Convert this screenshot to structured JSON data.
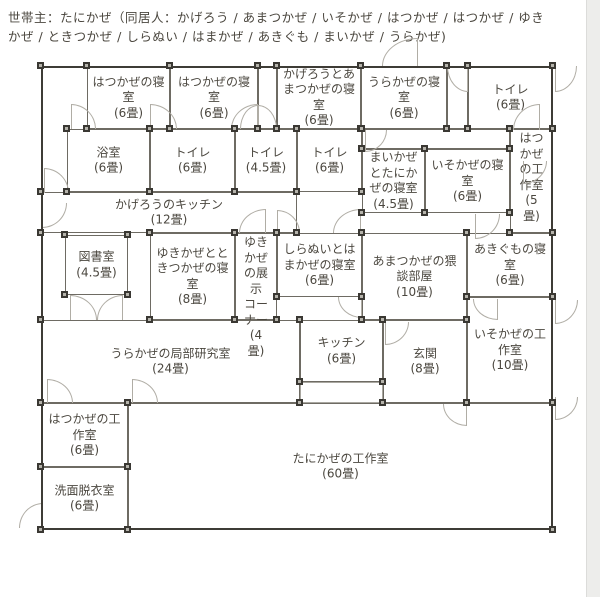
{
  "header": {
    "text": "世帯主：たにかぜ（同居人：かげろう / あまつかぜ / いそかぜ / はつかぜ / はつかぜ / ゆき\nかぜ / ときつかぜ / しらぬい / はまかぜ / あきぐも / まいかぜ / うらかぜ)"
  },
  "plan": {
    "outline": {
      "x": 41,
      "y": 66,
      "w": 512,
      "h": 464
    },
    "rooms": [
      {
        "id": "hatsukaze-bedroom-1",
        "label": "はつかぜの寝\n室\n(6畳)",
        "x": 87,
        "y": 66,
        "w": 83,
        "h": 63,
        "valign": "center"
      },
      {
        "id": "hatsukaze-bedroom-2",
        "label": "はつかぜの寝\n室\n(6畳)",
        "x": 170,
        "y": 66,
        "w": 88,
        "h": 63,
        "valign": "center"
      },
      {
        "id": "corridor-top-1",
        "label": "",
        "x": 258,
        "y": 66,
        "w": 19,
        "h": 63,
        "valign": "center"
      },
      {
        "id": "kagero-amatsukaze-bedroom",
        "label": "かげろうとあ\nまつかぜの寝\n室\n(6畳)",
        "x": 277,
        "y": 66,
        "w": 84,
        "h": 63,
        "valign": "center"
      },
      {
        "id": "urakaze-bedroom",
        "label": "うらかぜの寝\n室\n(6畳)",
        "x": 361,
        "y": 66,
        "w": 86,
        "h": 63,
        "valign": "center"
      },
      {
        "id": "corridor-top-2",
        "label": "",
        "x": 447,
        "y": 66,
        "w": 21,
        "h": 63,
        "valign": "center"
      },
      {
        "id": "toilet-1",
        "label": "トイレ\n(6畳)",
        "x": 468,
        "y": 66,
        "w": 85,
        "h": 63,
        "valign": "center"
      },
      {
        "id": "bathroom",
        "label": "浴室\n(6畳)",
        "x": 67,
        "y": 129,
        "w": 83,
        "h": 63,
        "valign": "center"
      },
      {
        "id": "toilet-2",
        "label": "トイレ\n(6畳)",
        "x": 150,
        "y": 129,
        "w": 85,
        "h": 63,
        "valign": "center"
      },
      {
        "id": "toilet-3",
        "label": "トイレ\n(4.5畳)",
        "x": 235,
        "y": 129,
        "w": 62,
        "h": 63,
        "valign": "center"
      },
      {
        "id": "toilet-4",
        "label": "トイレ\n(6畳)",
        "x": 297,
        "y": 129,
        "w": 65,
        "h": 63,
        "valign": "center"
      },
      {
        "id": "corridor-mid",
        "label": "",
        "x": 362,
        "y": 129,
        "w": 148,
        "h": 20,
        "valign": "center"
      },
      {
        "id": "maikaze-tanikaze-bedroom",
        "label": "まいかぜ\nとたにか\nぜの寝室\n(4.5畳)",
        "x": 362,
        "y": 149,
        "w": 63,
        "h": 64,
        "valign": "center"
      },
      {
        "id": "isokaze-bedroom",
        "label": "いそかぜの寝\n室\n(6畳)",
        "x": 425,
        "y": 149,
        "w": 85,
        "h": 64,
        "valign": "center"
      },
      {
        "id": "hatsukaze-workshop-5",
        "label": "はつ\nかぜ\nの工\n作室\n(5\n畳)",
        "x": 510,
        "y": 129,
        "w": 43,
        "h": 104,
        "valign": "top"
      },
      {
        "id": "kagero-kitchen",
        "label": "かげろうのキッチン\n(12畳)",
        "x": 41,
        "y": 192,
        "w": 256,
        "h": 41,
        "valign": "center"
      },
      {
        "id": "library",
        "label": "図書室\n(4.5畳)",
        "x": 65,
        "y": 235,
        "w": 63,
        "h": 60,
        "valign": "center"
      },
      {
        "id": "yukikaze-tokitsukaze-bedroom",
        "label": "ゆきかぜとと\nきつかぜの寝\n室\n(8畳)",
        "x": 150,
        "y": 233,
        "w": 85,
        "h": 87,
        "valign": "center"
      },
      {
        "id": "yukikaze-display-corner",
        "label": "ゆき\nかぜ\nの展\n示\nコー\nナー\n(4\n畳)",
        "x": 235,
        "y": 233,
        "w": 42,
        "h": 87,
        "valign": "top"
      },
      {
        "id": "shiranui-hamakaze-bedroom",
        "label": "しらぬいとは\nまかぜの寝室\n(6畳)",
        "x": 277,
        "y": 233,
        "w": 85,
        "h": 64,
        "valign": "center"
      },
      {
        "id": "amatsukaze-waidan-room",
        "label": "あまつかぜの猥\n談部屋\n(10畳)",
        "x": 362,
        "y": 233,
        "w": 105,
        "h": 87,
        "valign": "center"
      },
      {
        "id": "akigumo-bedroom",
        "label": "あきぐもの寝\n室\n(6畳)",
        "x": 467,
        "y": 233,
        "w": 86,
        "h": 64,
        "valign": "center"
      },
      {
        "id": "urakaze-lab",
        "label": "うらかぜの局部研究室\n(24畳)",
        "x": 41,
        "y": 320,
        "w": 259,
        "h": 83,
        "valign": "center"
      },
      {
        "id": "kitchen-2",
        "label": "キッチン\n(6畳)",
        "x": 300,
        "y": 320,
        "w": 83,
        "h": 62,
        "valign": "center"
      },
      {
        "id": "kitchen-2-lower",
        "label": "",
        "x": 300,
        "y": 382,
        "w": 83,
        "h": 21,
        "valign": "center",
        "light": true
      },
      {
        "id": "genkan",
        "label": "玄関\n(8畳)",
        "x": 383,
        "y": 320,
        "w": 84,
        "h": 83,
        "valign": "center"
      },
      {
        "id": "isokaze-workshop",
        "label": "いそかぜの工\n作室\n(10畳)",
        "x": 467,
        "y": 297,
        "w": 86,
        "h": 106,
        "valign": "center"
      },
      {
        "id": "hatsukaze-workshop-6",
        "label": "はつかぜの工\n作室\n(6畳)",
        "x": 41,
        "y": 403,
        "w": 87,
        "h": 64,
        "valign": "center"
      },
      {
        "id": "washroom",
        "label": "洗面脱衣室\n(6畳)",
        "x": 41,
        "y": 467,
        "w": 87,
        "h": 63,
        "valign": "center"
      },
      {
        "id": "tanikaze-workshop",
        "label": "たにかぜの工作室\n(60畳)",
        "x": 128,
        "y": 403,
        "w": 425,
        "h": 127,
        "valign": "center"
      }
    ],
    "doors": [
      {
        "x": 71,
        "y": 104,
        "w": 25,
        "h": 25,
        "hinge": "bl"
      },
      {
        "x": 150,
        "y": 104,
        "w": 27,
        "h": 25,
        "hinge": "bl"
      },
      {
        "x": 231,
        "y": 104,
        "w": 27,
        "h": 25,
        "hinge": "br"
      },
      {
        "x": 240,
        "y": 105,
        "w": 18,
        "h": 24,
        "hinge": "br"
      },
      {
        "x": 258,
        "y": 105,
        "w": 19,
        "h": 24,
        "hinge": "bl"
      },
      {
        "x": 382,
        "y": 38,
        "w": 36,
        "h": 28,
        "hinge": "br"
      },
      {
        "x": 447,
        "y": 66,
        "w": 21,
        "h": 26,
        "hinge": "tr"
      },
      {
        "x": 555,
        "y": 66,
        "w": 22,
        "h": 26,
        "hinge": "tl"
      },
      {
        "x": 513,
        "y": 104,
        "w": 27,
        "h": 26,
        "hinge": "br"
      },
      {
        "x": 365,
        "y": 130,
        "w": 22,
        "h": 22,
        "hinge": "tl"
      },
      {
        "x": 523,
        "y": 161,
        "w": 24,
        "h": 23,
        "hinge": "tl"
      },
      {
        "x": 475,
        "y": 214,
        "w": 25,
        "h": 25,
        "hinge": "tl"
      },
      {
        "x": 333,
        "y": 209,
        "w": 28,
        "h": 24,
        "hinge": "br"
      },
      {
        "x": 239,
        "y": 209,
        "w": 27,
        "h": 24,
        "hinge": "br"
      },
      {
        "x": 277,
        "y": 210,
        "w": 23,
        "h": 23,
        "hinge": "bl"
      },
      {
        "x": 44,
        "y": 168,
        "w": 25,
        "h": 25,
        "hinge": "bl"
      },
      {
        "x": 42,
        "y": 203,
        "w": 25,
        "h": 25,
        "hinge": "tl"
      },
      {
        "x": 70,
        "y": 295,
        "w": 27,
        "h": 25,
        "hinge": "bl"
      },
      {
        "x": 97,
        "y": 295,
        "w": 26,
        "h": 25,
        "hinge": "br"
      },
      {
        "x": 338,
        "y": 297,
        "w": 24,
        "h": 21,
        "hinge": "tr"
      },
      {
        "x": 385,
        "y": 322,
        "w": 24,
        "h": 23,
        "hinge": "tl"
      },
      {
        "x": 443,
        "y": 404,
        "w": 24,
        "h": 22,
        "hinge": "tr"
      },
      {
        "x": 555,
        "y": 300,
        "w": 23,
        "h": 24,
        "hinge": "tl"
      },
      {
        "x": 555,
        "y": 397,
        "w": 23,
        "h": 23,
        "hinge": "tl"
      },
      {
        "x": 47,
        "y": 379,
        "w": 26,
        "h": 24,
        "hinge": "bl"
      },
      {
        "x": 132,
        "y": 379,
        "w": 26,
        "h": 24,
        "hinge": "bl"
      },
      {
        "x": 19,
        "y": 503,
        "w": 24,
        "h": 25,
        "hinge": "br"
      },
      {
        "x": 473,
        "y": 299,
        "w": 25,
        "h": 21,
        "hinge": "tr"
      }
    ],
    "extra_handles": [
      [
        41,
        66
      ],
      [
        300,
        382
      ],
      [
        383,
        382
      ]
    ],
    "colors": {
      "wall_inner": "#6e6b63",
      "wall_outer": "#3e3c36",
      "door_arc": "#b0ada5",
      "handle_border": "#3a3833",
      "handle_fill": "#b5b3ab",
      "text": "#4b473f",
      "background": "#ffffff"
    }
  }
}
